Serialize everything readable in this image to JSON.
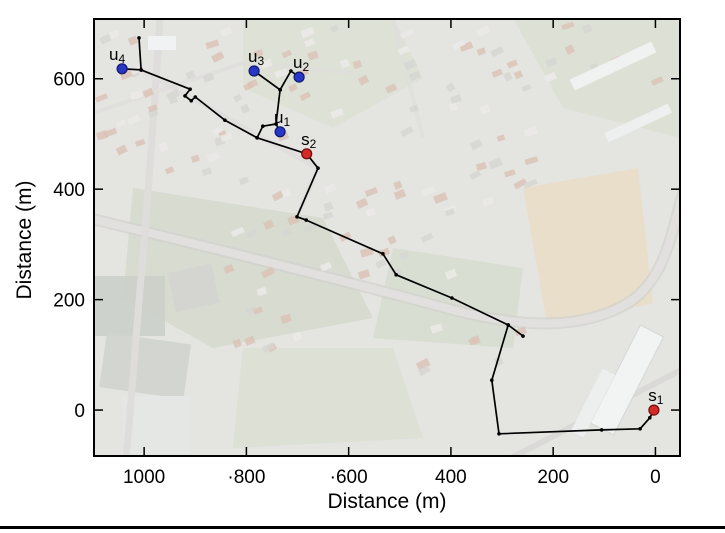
{
  "page": {
    "background": "#ffffff"
  },
  "chart_data": {
    "type": "scatter",
    "title": "",
    "xlabel": "Distance (m)",
    "ylabel": "Distance (m)",
    "xlim": [
      -50,
      1100
    ],
    "x_axis_reversed": true,
    "ylim": [
      -85,
      710
    ],
    "grid": false,
    "legend": null,
    "background_description": "washed-out aerial photo of a town with roads, houses, fields and warehouses",
    "x_ticks": [
      {
        "value": 1000,
        "label": "1000"
      },
      {
        "value": 800,
        "label": "·800"
      },
      {
        "value": 600,
        "label": "·600"
      },
      {
        "value": 400,
        "label": "400"
      },
      {
        "value": 200,
        "label": "200"
      },
      {
        "value": 0,
        "label": "0"
      }
    ],
    "y_ticks": [
      {
        "value": 0,
        "label": "0"
      },
      {
        "value": 200,
        "label": "200"
      },
      {
        "value": 400,
        "label": "400"
      },
      {
        "value": 600,
        "label": "600"
      }
    ],
    "markers": [
      {
        "id": "s1",
        "text": "s",
        "sub": "1",
        "x": 3,
        "y": 0,
        "color": "#d42a24",
        "edge": "#6e0d0d",
        "kind": "source"
      },
      {
        "id": "s2",
        "text": "s",
        "sub": "2",
        "x": 682,
        "y": 464,
        "color": "#d42a24",
        "edge": "#6e0d0d",
        "kind": "source"
      },
      {
        "id": "u1",
        "text": "u",
        "sub": "1",
        "x": 734,
        "y": 504,
        "color": "#2736c5",
        "edge": "#101a6e",
        "kind": "user"
      },
      {
        "id": "u2",
        "text": "u",
        "sub": "2",
        "x": 697,
        "y": 603,
        "color": "#2736c5",
        "edge": "#101a6e",
        "kind": "user"
      },
      {
        "id": "u3",
        "text": "u",
        "sub": "3",
        "x": 785,
        "y": 614,
        "color": "#2736c5",
        "edge": "#101a6e",
        "kind": "user"
      },
      {
        "id": "u4",
        "text": "u",
        "sub": "4",
        "x": 1043,
        "y": 618,
        "color": "#2736c5",
        "edge": "#101a6e",
        "kind": "user"
      }
    ],
    "route": {
      "color": "#000000",
      "segments": [
        [
          [
            1010,
            674
          ],
          [
            1006,
            616
          ]
        ],
        [
          [
            1006,
            616
          ],
          [
            1043,
            618
          ]
        ],
        [
          [
            1006,
            616
          ],
          [
            910,
            581
          ],
          [
            920,
            569
          ],
          [
            908,
            560
          ],
          [
            900,
            567
          ],
          [
            842,
            525
          ],
          [
            779,
            493
          ],
          [
            682,
            464
          ],
          [
            660,
            438
          ],
          [
            701,
            350
          ],
          [
            683,
            344
          ],
          [
            533,
            283
          ],
          [
            507,
            245
          ],
          [
            398,
            203
          ],
          [
            288,
            154
          ]
        ],
        [
          [
            288,
            154
          ],
          [
            259,
            134
          ]
        ],
        [
          [
            288,
            154
          ],
          [
            320,
            54
          ],
          [
            306,
            -43
          ],
          [
            105,
            -36
          ],
          [
            30,
            -34
          ],
          [
            11,
            -14
          ],
          [
            3,
            0
          ]
        ],
        [
          [
            779,
            493
          ],
          [
            768,
            514
          ],
          [
            742,
            518
          ],
          [
            734,
            580
          ]
        ],
        [
          [
            734,
            580
          ],
          [
            785,
            614
          ]
        ],
        [
          [
            734,
            580
          ],
          [
            713,
            614
          ],
          [
            697,
            603
          ]
        ],
        [
          [
            742,
            518
          ],
          [
            734,
            504
          ]
        ]
      ]
    }
  },
  "colors": {
    "user_marker": "#2736c5",
    "source_marker": "#d42a24",
    "route": "#000000",
    "axis": "#000000"
  }
}
